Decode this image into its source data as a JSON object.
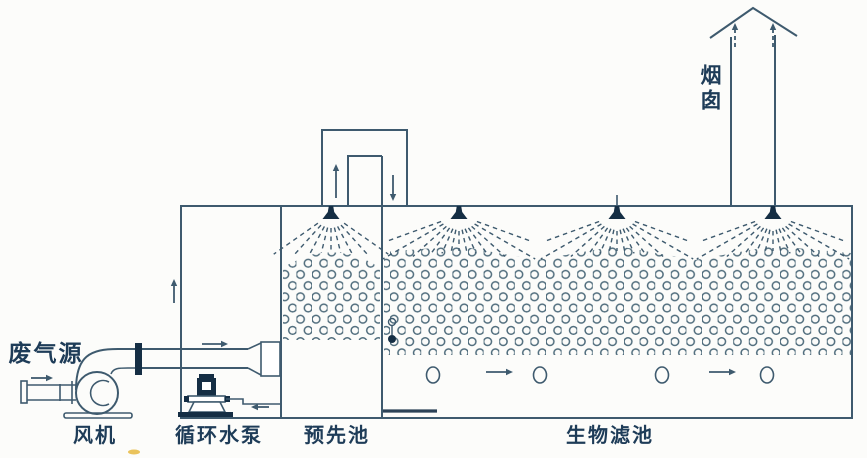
{
  "diagram": {
    "labels": {
      "waste_gas_source": "废气源",
      "fan": "风机",
      "circulating_pump": "循环水泵",
      "pre_tank": "预先池",
      "biofilter": "生物滤池",
      "chimney": "烟囱"
    },
    "colors": {
      "line": "#3e5a6e",
      "dark_fill": "#152e44",
      "media_ring": "#4e6b7b",
      "text": "#1e3c58",
      "background": "#fcfcfa",
      "speck": "#e6b93f"
    },
    "arrows": [
      {
        "name": "arrow-inlet-right",
        "direction": "right",
        "style": "solid"
      },
      {
        "name": "arrow-main-pipe-right",
        "direction": "right",
        "style": "solid"
      },
      {
        "name": "arrow-return-left",
        "direction": "left",
        "style": "solid"
      },
      {
        "name": "arrow-left-wall-up",
        "direction": "up",
        "style": "solid"
      },
      {
        "name": "arrow-duct-up",
        "direction": "up",
        "style": "solid"
      },
      {
        "name": "arrow-duct-down",
        "direction": "down",
        "style": "solid"
      },
      {
        "name": "arrow-plenum-right-1",
        "direction": "right",
        "style": "solid"
      },
      {
        "name": "arrow-plenum-right-2",
        "direction": "right",
        "style": "solid"
      },
      {
        "name": "arrow-chimney-up-left",
        "direction": "up",
        "style": "dashed"
      },
      {
        "name": "arrow-chimney-up-right",
        "direction": "up",
        "style": "dashed"
      }
    ],
    "components": [
      "fan-icon",
      "pump-icon",
      "pipe-flange",
      "gas-diffuser",
      "spray-nozzle-x4",
      "packing-media",
      "level-gauge",
      "air-bubble-x4",
      "chimney-cap",
      "drain-line"
    ]
  }
}
